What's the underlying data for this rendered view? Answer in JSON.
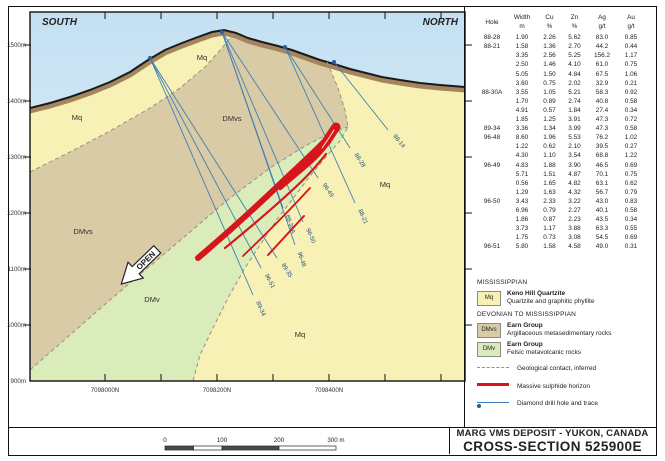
{
  "header": {
    "south_label": "SOUTH",
    "north_label": "NORTH"
  },
  "axes": {
    "elevation_labels": [
      {
        "text": "1500m",
        "y": 45
      },
      {
        "text": "1400m",
        "y": 101
      },
      {
        "text": "1300m",
        "y": 157
      },
      {
        "text": "1200m",
        "y": 213
      },
      {
        "text": "1100m",
        "y": 269
      },
      {
        "text": "1000m",
        "y": 325
      },
      {
        "text": "900m",
        "y": 381
      }
    ],
    "northing_labels": [
      {
        "text": "7098000N",
        "x": 105
      },
      {
        "text": "7098200N",
        "x": 217
      },
      {
        "text": "7098400N",
        "x": 329
      }
    ],
    "tick_xs": [
      105,
      161,
      217,
      273,
      329,
      385,
      441
    ]
  },
  "map": {
    "unit_labels": [
      {
        "text": "Mq",
        "x": 77,
        "y": 120
      },
      {
        "text": "Mq",
        "x": 202,
        "y": 60
      },
      {
        "text": "DMvs",
        "x": 232,
        "y": 121
      },
      {
        "text": "DMvs",
        "x": 83,
        "y": 234
      },
      {
        "text": "DMv",
        "x": 152,
        "y": 302
      },
      {
        "text": "Mq",
        "x": 385,
        "y": 187
      },
      {
        "text": "Mq",
        "x": 300,
        "y": 337
      }
    ],
    "open_label": "OPEN",
    "drill_holes": [
      {
        "name": "89-34",
        "collar": [
          150,
          58
        ],
        "end": [
          253,
          295
        ]
      },
      {
        "name": "96-51",
        "collar": [
          150,
          58
        ],
        "end": [
          261,
          268
        ]
      },
      {
        "name": "89-35",
        "collar": [
          150,
          58
        ],
        "end": [
          277,
          258
        ]
      },
      {
        "name": "96-48",
        "collar": [
          222,
          32
        ],
        "end": [
          295,
          245
        ]
      },
      {
        "name": "96-50",
        "collar": [
          222,
          32
        ],
        "end": [
          303,
          222
        ]
      },
      {
        "name": "88-30A",
        "collar": [
          222,
          32
        ],
        "end": [
          283,
          208
        ]
      },
      {
        "name": "96-49",
        "collar": [
          222,
          32
        ],
        "end": [
          318,
          178
        ]
      },
      {
        "name": "88-28",
        "collar": [
          285,
          47
        ],
        "end": [
          350,
          148
        ]
      },
      {
        "name": "88-21",
        "collar": [
          285,
          47
        ],
        "end": [
          355,
          203
        ]
      },
      {
        "name": "88-14",
        "collar": [
          334,
          62
        ],
        "end": [
          388,
          130
        ]
      }
    ],
    "collars": [
      [
        150,
        58
      ],
      [
        222,
        32
      ],
      [
        285,
        47
      ],
      [
        334,
        62
      ]
    ]
  },
  "table": {
    "headers": {
      "hole": "Hole",
      "width": "Width",
      "cu": "Cu",
      "zn": "Zn",
      "ag": "Ag",
      "au": "Au",
      "u_width": "m",
      "u_cu": "%",
      "u_zn": "%",
      "u_ag": "g/t",
      "u_au": "g/t"
    },
    "rows": [
      [
        "88-28",
        "1.90",
        "2.26",
        "5.62",
        "83.0",
        "0.85"
      ],
      [
        "88-21",
        "1.58",
        "1.36",
        "2.70",
        "44.2",
        "0.44"
      ],
      [
        "",
        "3.35",
        "2.56",
        "5.25",
        "156.2",
        "1.17"
      ],
      [
        "",
        "2.50",
        "1.46",
        "4.10",
        "61.0",
        "0.75"
      ],
      [
        "",
        "5.05",
        "1.50",
        "4.84",
        "67.5",
        "1.06"
      ],
      [
        "",
        "3.60",
        "0.75",
        "2.02",
        "32.9",
        "0.21"
      ],
      [
        "88-30A",
        "3.55",
        "1.05",
        "5.21",
        "58.3",
        "0.92"
      ],
      [
        "",
        "1.70",
        "0.89",
        "2.74",
        "40.8",
        "0.58"
      ],
      [
        "",
        "4.91",
        "0.57",
        "1.84",
        "27.4",
        "0.34"
      ],
      [
        "",
        "1.85",
        "1.25",
        "3.91",
        "47.3",
        "0.72"
      ],
      [
        "89-34",
        "3.36",
        "1.34",
        "3.99",
        "47.3",
        "0.58"
      ],
      [
        "96-48",
        "8.60",
        "1.96",
        "5.53",
        "76.2",
        "1.02"
      ],
      [
        "",
        "1.22",
        "0.62",
        "2.10",
        "39.5",
        "0.27"
      ],
      [
        "",
        "4.30",
        "1.10",
        "3.54",
        "68.8",
        "1.22"
      ],
      [
        "96-49",
        "4.83",
        "1.88",
        "3.90",
        "46.5",
        "0.69"
      ],
      [
        "",
        "5.71",
        "1.51",
        "4.87",
        "70.1",
        "0.75"
      ],
      [
        "",
        "0.56",
        "1.65",
        "4.82",
        "63.1",
        "0.62"
      ],
      [
        "",
        "1.29",
        "1.63",
        "4.32",
        "56.7",
        "0.79"
      ],
      [
        "96-50",
        "3.43",
        "2.33",
        "3.22",
        "43.0",
        "0.83"
      ],
      [
        "",
        "6.96",
        "0.79",
        "2.27",
        "40.1",
        "0.58"
      ],
      [
        "",
        "1.86",
        "0.87",
        "2.23",
        "43.5",
        "0.34"
      ],
      [
        "",
        "3.73",
        "1.17",
        "3.88",
        "63.3",
        "0.55"
      ],
      [
        "",
        "1.75",
        "0.73",
        "3.08",
        "54.5",
        "0.69"
      ],
      [
        "96-51",
        "5.80",
        "1.58",
        "4.58",
        "49.0",
        "0.31"
      ]
    ]
  },
  "legend": {
    "era1": "MISSISSIPPIAN",
    "era2": "DEVONIAN TO MISSISSIPPIAN",
    "units": [
      {
        "code": "Mq",
        "name": "Keno Hill Quartzite",
        "desc": "Quartzite and graphitic phyllite",
        "color": "#f7f1b6"
      },
      {
        "code": "DMvs",
        "name": "Earn Group",
        "desc": "Argillaceous metasedimentary rocks",
        "color": "#d9cba6"
      },
      {
        "code": "DMv",
        "name": "Earn Group",
        "desc": "Felsic metavolcanic rocks",
        "color": "#d9ecba"
      }
    ],
    "symbols": [
      {
        "label": "Geological contact, inferred"
      },
      {
        "label": "Massive sulphide horizon"
      },
      {
        "label": "Diamond drill hole and trace"
      }
    ]
  },
  "scalebar": {
    "labels": [
      {
        "text": "0",
        "x": 165
      },
      {
        "text": "100",
        "x": 222
      },
      {
        "text": "200",
        "x": 279
      },
      {
        "text": "300 m",
        "x": 336
      }
    ]
  },
  "title_block": {
    "line1": "MARG VMS DEPOSIT - YUKON, CANADA",
    "line2": "CROSS-SECTION 525900E"
  },
  "colors": {
    "sky_top": "#c3e0f2",
    "sky_bottom": "#ecf6fb",
    "mq": "#f7f1b6",
    "dmvs": "#d9cba6",
    "dmv": "#d9ecba",
    "weathering": "#a5855d",
    "contact_dash": "#9a8f7a",
    "drill_line": "#3f7fb5",
    "drill_label": "#1d4e79",
    "sulphide_red": "#d6151c",
    "frame": "#111111"
  }
}
